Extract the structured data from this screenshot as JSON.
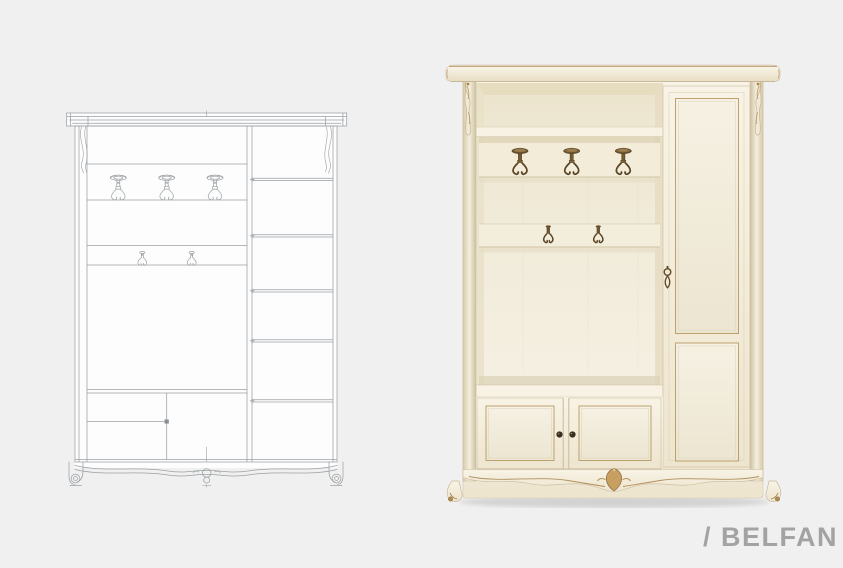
{
  "page": {
    "width": 843,
    "height": 568,
    "background": "#f0f0f0"
  },
  "brand": {
    "slash": "/",
    "name": "BELFAN"
  },
  "views": {
    "drawing": {
      "large_hooks": 3,
      "small_hooks": 2,
      "side_shelves": 5,
      "lower_compartments": 3
    },
    "photo": {
      "large_hooks": 3,
      "small_hooks": 2,
      "lower_doors": 2,
      "door_knobs": 2,
      "tall_door_panels": 2
    }
  },
  "colors": {
    "background": "#f0f0f0",
    "logo-gray": "#a3a3a3",
    "line-gray": "#9aa0a4",
    "drawing-white": "#fdfdfd",
    "cream": "#f3edda",
    "cream-light": "#f8f4e8",
    "cream-dark": "#e6dcc2",
    "cream-shadow": "#d9cfb4",
    "gold": "#ab8650",
    "gold-dark": "#8a6a3e",
    "bronze": "#75592f",
    "bronze-dark": "#4c3a22",
    "knob": "#372c20",
    "floor-shadow": "#c9c9c9"
  }
}
